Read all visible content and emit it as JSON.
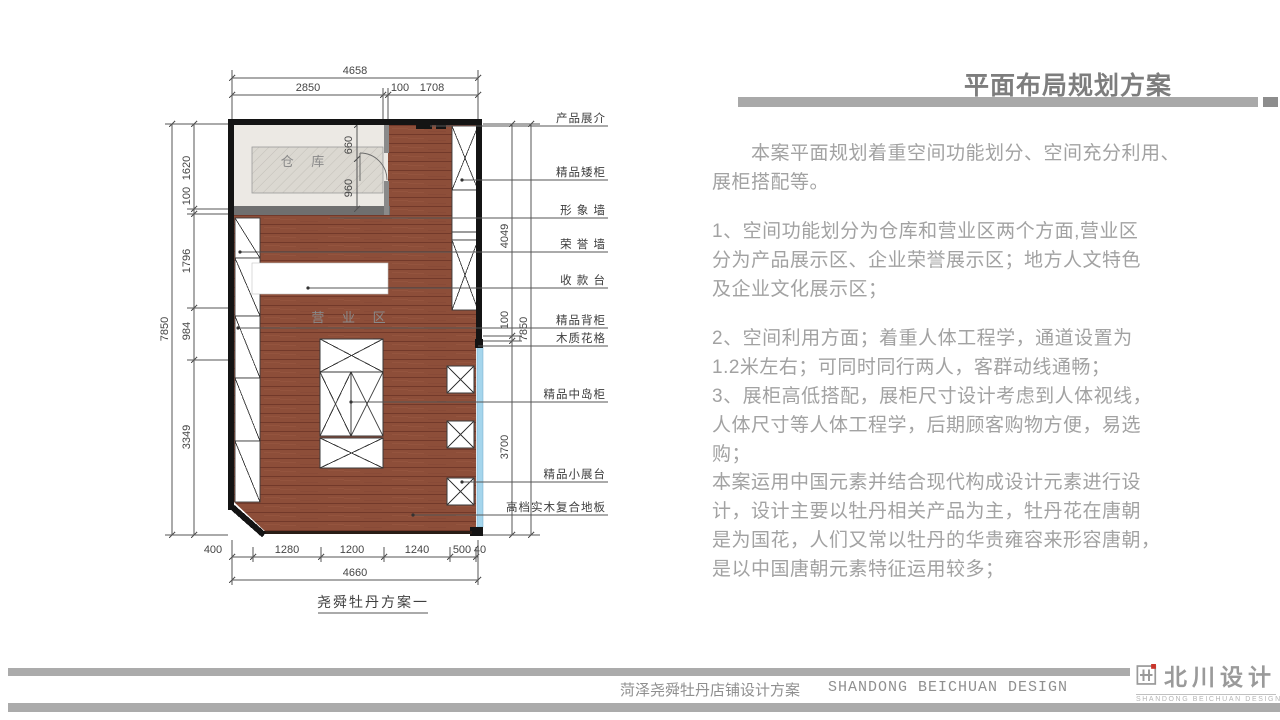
{
  "title": "平面布局规划方案",
  "paragraphs": {
    "intro": "　　本案平面规划着重空间功能划分、空间充分利用、\n展柜搭配等。",
    "item1": "1、空间功能划分为仓库和营业区两个方面,营业区\n分为产品展示区、企业荣誉展示区；地方人文特色\n及企业文化展示区；",
    "item23": "2、空间利用方面；着重人体工程学，通道设置为\n1.2米左右；可同时同行两人，客群动线通畅；\n3、展柜高低搭配，展柜尺寸设计考虑到人体视线，\n人体尺寸等人体工程学，后期顾客购物方便，易选\n购；",
    "closing": "本案运用中国元素并结合现代构成设计元素进行设\n计，设计主要以牡丹相关产品为主，牡丹花在唐朝\n是为国花，人们又常以牡丹的华贵雍容来形容唐朝，\n是以中国唐朝元素特征运用较多；"
  },
  "plan": {
    "caption": "尧舜牡丹方案一",
    "rooms": {
      "warehouse": "仓  库",
      "business": "营 业 区"
    },
    "dims": {
      "top_overall": "4658",
      "top": [
        "2850",
        "100",
        "1708"
      ],
      "left_overall": "7850",
      "left": [
        "1620",
        "100",
        "1796",
        "984",
        "3349"
      ],
      "right": [
        "4049",
        "100",
        "3700"
      ],
      "right_overall": "7850",
      "door": [
        "660",
        "960"
      ],
      "bottom": [
        "400",
        "1280",
        "1200",
        "1240",
        "500",
        "40"
      ],
      "bottom_overall": "4660"
    },
    "labels": [
      "产品展介",
      "精品矮柜",
      "形 象 墙",
      "荣 誉 墙",
      "收 款 台",
      "精品背柜",
      "木质花格",
      "精品中岛柜",
      "精品小展台",
      "高档实木复合地板"
    ]
  },
  "footer": {
    "project": "菏泽尧舜牡丹店铺设计方案",
    "company_en": "SHANDONG BEICHUAN DESIGN"
  },
  "logo": {
    "name": "北川设计",
    "sub": "SHANDONG BEICHUAN DESIGN"
  },
  "colors": {
    "wood": "#8d4e39",
    "glass": "#a5d5ec",
    "bar": "#ababab",
    "accent_red": "#c9342a"
  }
}
